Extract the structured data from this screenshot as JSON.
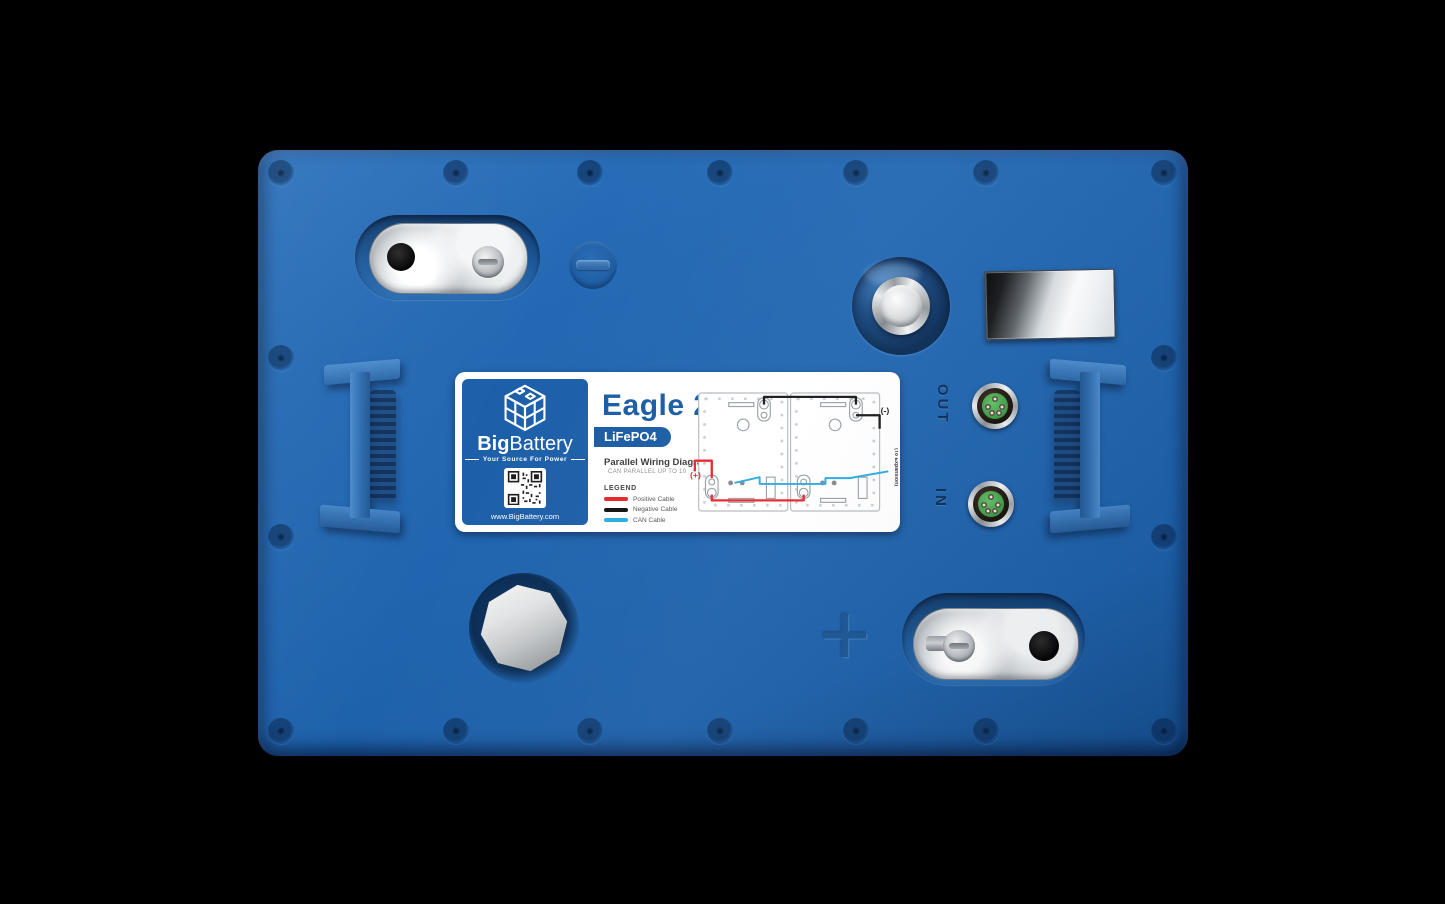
{
  "product_label": {
    "brand": {
      "name_bold": "Big",
      "name_regular": "Battery",
      "tagline": "Your Source For Power",
      "website": "www.BigBattery.com"
    },
    "model": "Eagle 2",
    "chemistry": "LiFePO4",
    "wiring": {
      "title": "Parallel Wiring Diagram",
      "subtitle": "CAN PARALLEL UP TO 10",
      "legend_title": "LEGEND",
      "legend": [
        {
          "label": "Positive Cable",
          "color": "#e8262a"
        },
        {
          "label": "Negative Cable",
          "color": "#111111"
        },
        {
          "label": "CAN Cable",
          "color": "#29abe2"
        }
      ],
      "annotations": {
        "positive": "(+)",
        "negative": "(-)",
        "expansion": "(To Expansion)"
      }
    }
  },
  "ports": {
    "out_label": "OUT",
    "in_label": "IN"
  },
  "molded_markings": {
    "positive_symbol": "+"
  },
  "colors": {
    "case_blue": "#2065af",
    "brand_blue": "#1d5fa9",
    "connector_green": "#3c9d44",
    "positive_red": "#e8262a",
    "negative_black": "#111111",
    "can_cyan": "#29abe2",
    "chrome_silver": "#e9ecee",
    "background": "#000000"
  }
}
